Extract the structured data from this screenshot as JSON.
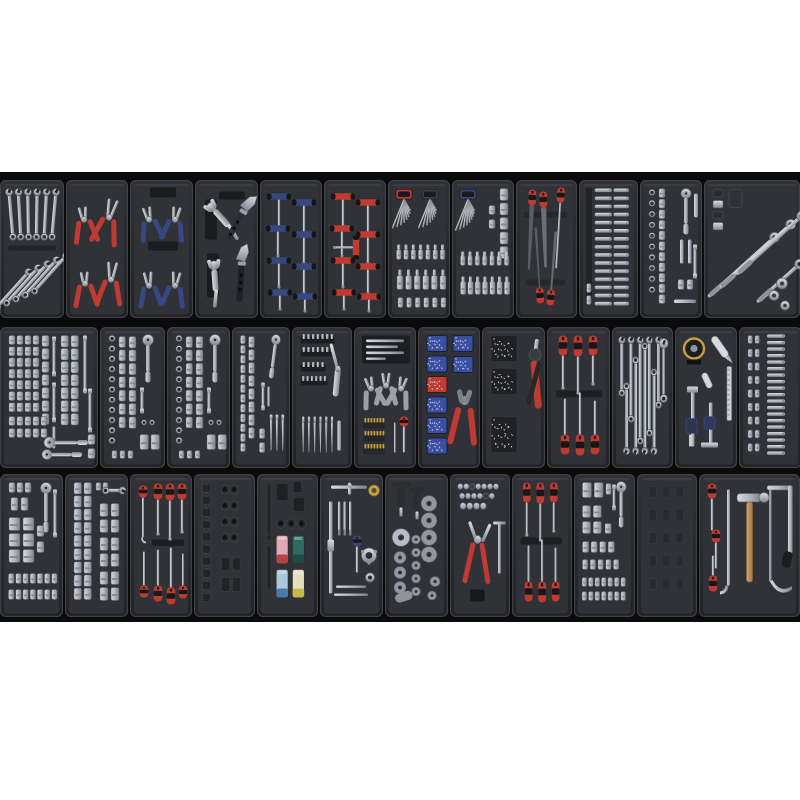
{
  "scene": {
    "type": "photograph",
    "subject": "modular tool chest drawer insert trays filled with hand tools, three rows on black background with white margins",
    "canvas": {
      "width": 800,
      "height": 800
    },
    "photo_area": {
      "x": 0,
      "y": 172,
      "width": 800,
      "height": 450
    },
    "background": "#ffffff",
    "photo_background": "#0b0b0c"
  },
  "palette": {
    "metal": "#b6bbc2",
    "metal_dark": "#878d95",
    "metal_light": "#d9dce0",
    "tool_black": "#232427",
    "red_handle": "#bf3a31",
    "blue_handle": "#37477f",
    "yellow_bits": "#c9a13b",
    "wood": "#c09559",
    "tray_body": "#2a2b2f",
    "tray_inner": "#313237",
    "socket_pink": "#dfa9b5",
    "socket_teal": "#2f6b63",
    "socket_lightblue": "#aac7dd",
    "socket_cream": "#e6dfbe"
  },
  "rows": [
    {
      "y": 180,
      "height": 138,
      "trays": [
        {
          "x": 0,
          "w": 64,
          "kind": "spanners",
          "name": "combination-spanner-set",
          "desc": "silver combination spanners, vertical set above diagonal set",
          "params": {
            "count_top": 6,
            "count_bottom": 5
          }
        },
        {
          "x": 66,
          "w": 62,
          "kind": "pliersRed",
          "name": "pliers-set-red",
          "desc": "4 pliers with red grips: cutters, groove-joint, long nose",
          "params": {
            "handle": "#bf3a31"
          }
        },
        {
          "x": 130,
          "w": 63,
          "kind": "circlip",
          "name": "circlip-pliers-set",
          "desc": "4 circlip pliers with blue grips",
          "params": {
            "handle": "#37477f"
          }
        },
        {
          "x": 195,
          "w": 63,
          "kind": "adjustLock",
          "name": "adjustable-wrenches-locking-pliers",
          "desc": "2 adjustable wrenches and 2 locking pliers",
          "params": {}
        },
        {
          "x": 260,
          "w": 62,
          "kind": "tHandles",
          "name": "t-handle-hex-keys-blue",
          "desc": "8 blue T-handle hex keys",
          "params": {
            "handle": "#37477f",
            "count": 8
          }
        },
        {
          "x": 324,
          "w": 62,
          "kind": "tHandles",
          "name": "t-handle-hex-keys-red",
          "desc": "9 red T-handle hex keys",
          "params": {
            "handle": "#bf3a31",
            "count": 9
          }
        },
        {
          "x": 388,
          "w": 62,
          "kind": "hexBits",
          "name": "hex-key-and-bit-socket-set",
          "desc": "two hex key fans (red and black holders) over bit sockets",
          "params": {
            "holders": [
              "#bf3a31",
              "#3b3e45"
            ]
          }
        },
        {
          "x": 452,
          "w": 62,
          "kind": "hexBitsB",
          "name": "hex-keys-sockets-bits",
          "desc": "blue hex key fan, socket column, bit socket rows",
          "params": {
            "holder": "#37477f"
          }
        },
        {
          "x": 516,
          "w": 61,
          "kind": "files",
          "name": "engineers-file-set",
          "desc": "5 files with red handles, blades crossing",
          "params": {
            "handle": "#bf3a31"
          }
        },
        {
          "x": 579,
          "w": 59,
          "kind": "longBits",
          "name": "long-bit-socket-set",
          "desc": "two columns of long silver bits",
          "params": {}
        },
        {
          "x": 640,
          "w": 62,
          "kind": "ratchetTray",
          "name": "socket-rail-and-ratchet",
          "desc": "ring and socket columns with ratchet, drivers and extensions",
          "params": {}
        },
        {
          "x": 704,
          "w": 96,
          "kind": "breakerBars",
          "name": "breaker-bar-set",
          "desc": "long breaker/ratchet bars diagonal, adaptors and discs",
          "params": {}
        }
      ]
    },
    {
      "y": 327,
      "height": 141,
      "trays": [
        {
          "x": 0,
          "w": 98,
          "kind": "bigSocketSet",
          "name": "large-socket-set",
          "desc": "large socket grid with extensions and two ratchets",
          "params": {}
        },
        {
          "x": 100,
          "w": 65,
          "kind": "socketsRatchet",
          "name": "quarter-drive-socket-set",
          "desc": "ring column, deep sockets, ratchet",
          "params": {}
        },
        {
          "x": 167,
          "w": 63,
          "kind": "socketsRatchet",
          "name": "three-eighth-drive-socket-set",
          "desc": "ring column, deep sockets, ratchet",
          "params": {}
        },
        {
          "x": 232,
          "w": 58,
          "kind": "socketsPunches",
          "name": "sockets-ratchet-punches",
          "desc": "socket columns, ratchet, extensions, taper punches",
          "params": {}
        },
        {
          "x": 292,
          "w": 60,
          "kind": "bitsRiveter",
          "name": "bit-holders-and-nut-riveter",
          "desc": "black bit rails, nut riveter, punches and chisel",
          "params": {}
        },
        {
          "x": 354,
          "w": 62,
          "kind": "miniPliers",
          "name": "mini-pliers-needle-files-bits",
          "desc": "needle files, 3 mini pliers, gold bit strips, precision driver",
          "params": {}
        },
        {
          "x": 418,
          "w": 62,
          "kind": "terminals",
          "name": "terminals-and-crimping-tool",
          "desc": "terminal compartments (blue and red) with red crimping tool",
          "params": {
            "compartments": [
              "#3b4fa0",
              "#3b4fa0",
              "#bf3a31",
              "#3b4fa0",
              "#3b4fa0",
              "#3b4fa0"
            ],
            "handle": "#bf3a31"
          }
        },
        {
          "x": 482,
          "w": 63,
          "kind": "rivets",
          "name": "rivet-assortment-and-gun",
          "desc": "three rivet compartments and red riveting gun",
          "params": {
            "handle": "#bf3a31"
          }
        },
        {
          "x": 547,
          "w": 63,
          "kind": "screwdrivers6",
          "name": "screwdriver-set",
          "desc": "6 red/black screwdrivers, 3 up 3 down",
          "params": {
            "handle": "#bf3a31"
          }
        },
        {
          "x": 612,
          "w": 61,
          "kind": "spannerSet",
          "name": "combination-spanner-rack",
          "desc": "alternating combination spanners with flare-nut spanner",
          "params": {}
        },
        {
          "x": 675,
          "w": 62,
          "kind": "measuring",
          "name": "measuring-and-cutting-tools",
          "desc": "tape measure, utility knife, rule, vernier calipers",
          "params": {
            "tape": "#c9a13b"
          }
        },
        {
          "x": 739,
          "w": 63,
          "kind": "bitRows",
          "name": "bit-assortment",
          "desc": "vertical bit pairs and stacked horizontal bits",
          "params": {}
        }
      ]
    },
    {
      "y": 474,
      "height": 143,
      "trays": [
        {
          "x": 0,
          "w": 63,
          "kind": "assortedSockets",
          "name": "socket-and-ratchet-assortment",
          "desc": "assorted sockets, ratchet, extension, two rows of bits",
          "params": {}
        },
        {
          "x": 65,
          "w": 63,
          "kind": "deepSockets",
          "name": "deep-socket-set",
          "desc": "deep socket columns with open-end spanner",
          "params": {}
        },
        {
          "x": 130,
          "w": 62,
          "kind": "picks",
          "name": "picks-hooks-screwdrivers",
          "desc": "red handled picks, hooks and screwdrivers",
          "params": {
            "handle": "#bf3a31"
          }
        },
        {
          "x": 194,
          "w": 61,
          "kind": "impactSockets",
          "name": "impact-socket-set",
          "desc": "black impact deep sockets and ring pairs",
          "params": {}
        },
        {
          "x": 257,
          "w": 61,
          "kind": "impactColor",
          "name": "impact-adaptors-colour-sockets",
          "desc": "impact bars, adaptors and 4 colour-coded deep sockets",
          "params": {
            "sockets": [
              [
                "#dfa9b5",
                "#b4434a"
              ],
              [
                "#2f6b63",
                "#1d4a44"
              ],
              [
                "#aac7dd",
                "#4a7aa8"
              ],
              [
                "#e6dfbe",
                "#c9b84a"
              ]
            ]
          }
        },
        {
          "x": 320,
          "w": 63,
          "kind": "tapDie",
          "name": "tap-and-die-set",
          "desc": "tap wrenches, taps, die holders, yellow die",
          "params": {}
        },
        {
          "x": 385,
          "w": 63,
          "kind": "brakeKit",
          "name": "brake-caliper-rewind-kit",
          "desc": "wind-back tools and grey adaptor discs",
          "params": {}
        },
        {
          "x": 450,
          "w": 60,
          "kind": "brakePliers",
          "name": "fittings-and-brake-pliers",
          "desc": "rows of fittings with large red-handled pliers and T-bar",
          "params": {
            "handle": "#bf3a31"
          }
        },
        {
          "x": 512,
          "w": 60,
          "kind": "screwdrivers6",
          "name": "screwdriver-set-2",
          "desc": "6 red/black screwdrivers, 3 up 3 down",
          "params": {
            "handle": "#bf3a31"
          }
        },
        {
          "x": 574,
          "w": 61,
          "kind": "socketBits",
          "name": "socket-and-bit-tray",
          "desc": "cylinders, ratchet, socket pairs and bit rows",
          "params": {}
        },
        {
          "x": 637,
          "w": 60,
          "kind": "emptyTray",
          "name": "empty-tray",
          "desc": "empty moulded tray",
          "params": {}
        },
        {
          "x": 699,
          "w": 101,
          "kind": "hammerSaw",
          "name": "hammer-hacksaw-pry-bar",
          "desc": "ball-pein hammer, hacksaw, pry bar, red screwdrivers",
          "params": {
            "handle": "#bf3a31"
          }
        }
      ]
    }
  ]
}
